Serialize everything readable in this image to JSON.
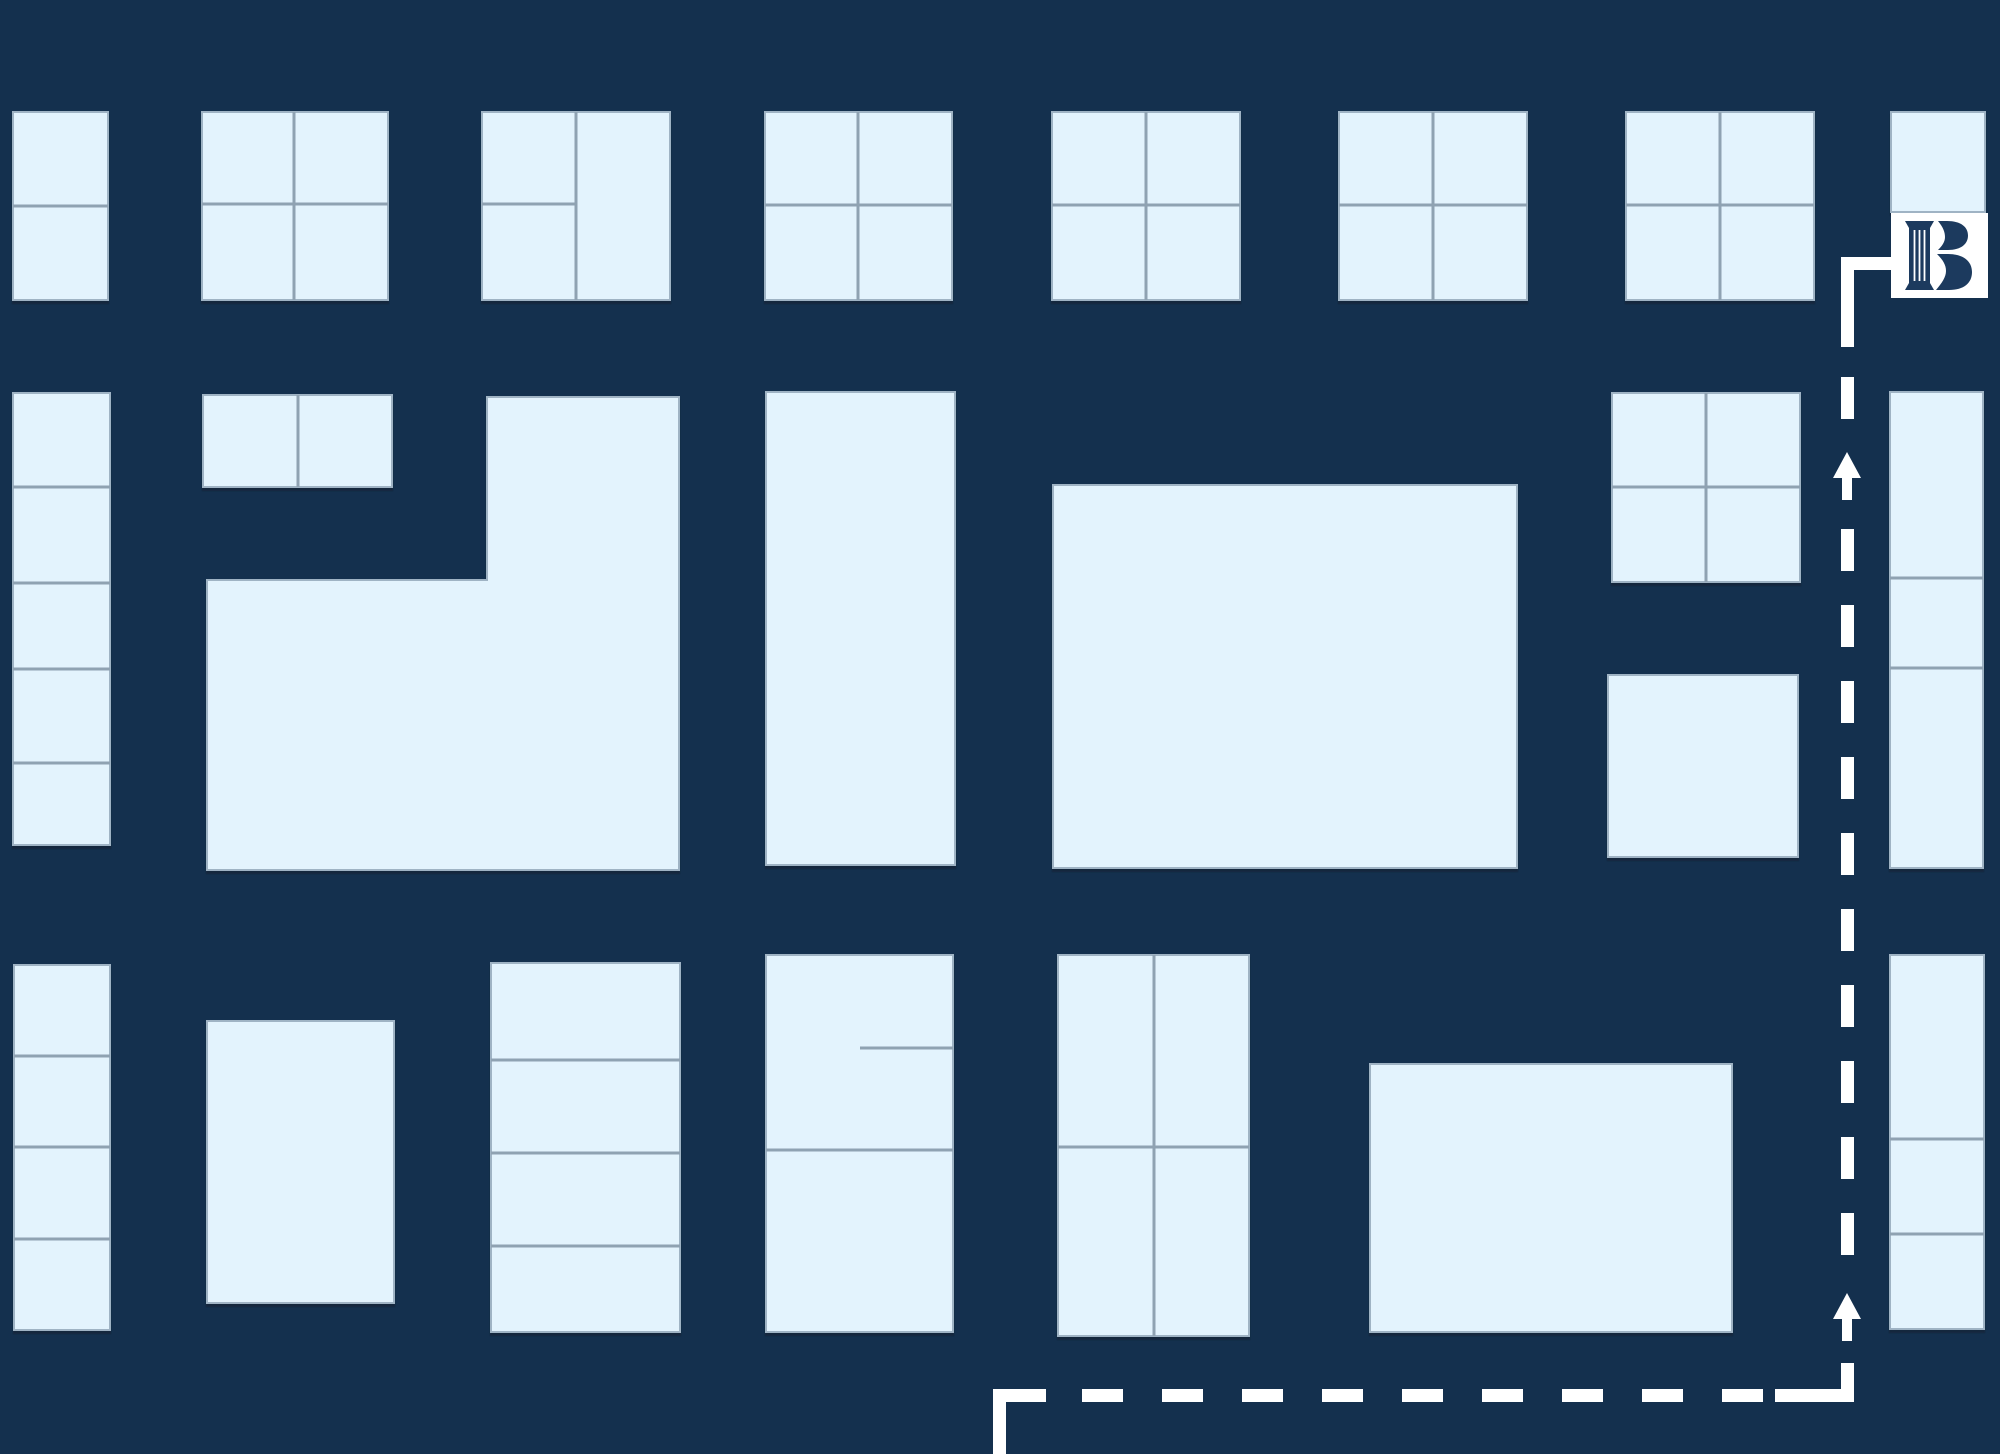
{
  "canvas": {
    "width": 2000,
    "height": 1454
  },
  "palette": {
    "background": "#14304E",
    "block_fill": "#E3F3FD",
    "block_stroke": "#9FB3C4",
    "block_shadow": "#0A1C30",
    "divider": "#8FA2B2",
    "route": "#FFFFFF",
    "marker_box": "#FFFFFF",
    "marker_glyph": "#1C3A5E"
  },
  "marker": {
    "label": "B",
    "icon": "bank-column-b-logo",
    "x": 1891,
    "y": 213,
    "width": 97,
    "height": 85
  },
  "blocks": [
    {
      "x": 13,
      "y": 112,
      "w": 95,
      "h": 188,
      "dividers": [
        {
          "o": "h",
          "pos": 206,
          "from": 13,
          "to": 108
        }
      ]
    },
    {
      "x": 202,
      "y": 112,
      "w": 186,
      "h": 188,
      "dividers": [
        {
          "o": "v",
          "pos": 294,
          "from": 112,
          "to": 300
        },
        {
          "o": "h",
          "pos": 204,
          "from": 202,
          "to": 388
        }
      ]
    },
    {
      "x": 482,
      "y": 112,
      "w": 188,
      "h": 188,
      "dividers": [
        {
          "o": "v",
          "pos": 576,
          "from": 112,
          "to": 300
        },
        {
          "o": "h",
          "pos": 204,
          "from": 482,
          "to": 576
        }
      ]
    },
    {
      "x": 765,
      "y": 112,
      "w": 187,
      "h": 188,
      "dividers": [
        {
          "o": "v",
          "pos": 858,
          "from": 112,
          "to": 300
        },
        {
          "o": "h",
          "pos": 205,
          "from": 765,
          "to": 952
        }
      ]
    },
    {
      "x": 1052,
      "y": 112,
      "w": 188,
      "h": 188,
      "dividers": [
        {
          "o": "v",
          "pos": 1146,
          "from": 112,
          "to": 300
        },
        {
          "o": "h",
          "pos": 205,
          "from": 1052,
          "to": 1240
        }
      ]
    },
    {
      "x": 1339,
      "y": 112,
      "w": 188,
      "h": 188,
      "dividers": [
        {
          "o": "v",
          "pos": 1433,
          "from": 112,
          "to": 300
        },
        {
          "o": "h",
          "pos": 205,
          "from": 1339,
          "to": 1527
        }
      ]
    },
    {
      "x": 1626,
      "y": 112,
      "w": 188,
      "h": 188,
      "dividers": [
        {
          "o": "v",
          "pos": 1720,
          "from": 112,
          "to": 300
        },
        {
          "o": "h",
          "pos": 205,
          "from": 1626,
          "to": 1814
        }
      ]
    },
    {
      "x": 1891,
      "y": 112,
      "w": 94,
      "h": 100,
      "dividers": []
    },
    {
      "x": 13,
      "y": 393,
      "w": 97,
      "h": 452,
      "dividers": [
        {
          "o": "h",
          "pos": 487,
          "from": 13,
          "to": 110
        },
        {
          "o": "h",
          "pos": 583,
          "from": 13,
          "to": 110
        },
        {
          "o": "h",
          "pos": 669,
          "from": 13,
          "to": 110
        },
        {
          "o": "h",
          "pos": 763,
          "from": 13,
          "to": 110
        }
      ]
    },
    {
      "x": 203,
      "y": 395,
      "w": 189,
      "h": 92,
      "dividers": [
        {
          "o": "v",
          "pos": 298,
          "from": 395,
          "to": 487
        }
      ]
    },
    {
      "type": "polygon",
      "points": "487,397 679,397 679,870 207,870 207,580 487,580",
      "dividers": []
    },
    {
      "x": 766,
      "y": 392,
      "w": 189,
      "h": 473,
      "dividers": []
    },
    {
      "x": 1053,
      "y": 485,
      "w": 464,
      "h": 383,
      "dividers": []
    },
    {
      "x": 1612,
      "y": 393,
      "w": 188,
      "h": 189,
      "dividers": [
        {
          "o": "v",
          "pos": 1706,
          "from": 393,
          "to": 582
        },
        {
          "o": "h",
          "pos": 487,
          "from": 1612,
          "to": 1800
        }
      ]
    },
    {
      "x": 1608,
      "y": 675,
      "w": 190,
      "h": 182,
      "dividers": []
    },
    {
      "x": 1890,
      "y": 392,
      "w": 93,
      "h": 476,
      "dividers": [
        {
          "o": "h",
          "pos": 578,
          "from": 1890,
          "to": 1983
        },
        {
          "o": "h",
          "pos": 668,
          "from": 1890,
          "to": 1983
        }
      ]
    },
    {
      "x": 14,
      "y": 965,
      "w": 96,
      "h": 365,
      "dividers": [
        {
          "o": "h",
          "pos": 1056,
          "from": 14,
          "to": 110
        },
        {
          "o": "h",
          "pos": 1147,
          "from": 14,
          "to": 110
        },
        {
          "o": "h",
          "pos": 1239,
          "from": 14,
          "to": 110
        }
      ]
    },
    {
      "x": 207,
      "y": 1021,
      "w": 187,
      "h": 282,
      "dividers": []
    },
    {
      "x": 491,
      "y": 963,
      "w": 189,
      "h": 369,
      "dividers": [
        {
          "o": "h",
          "pos": 1060,
          "from": 491,
          "to": 680
        },
        {
          "o": "h",
          "pos": 1153,
          "from": 491,
          "to": 680
        },
        {
          "o": "h",
          "pos": 1246,
          "from": 491,
          "to": 680
        }
      ]
    },
    {
      "x": 766,
      "y": 955,
      "w": 187,
      "h": 377,
      "dividers": [
        {
          "o": "h",
          "pos": 1048,
          "from": 860,
          "to": 953
        },
        {
          "o": "h",
          "pos": 1150,
          "from": 766,
          "to": 953
        }
      ]
    },
    {
      "x": 1058,
      "y": 955,
      "w": 191,
      "h": 381,
      "dividers": [
        {
          "o": "v",
          "pos": 1154,
          "from": 955,
          "to": 1336
        },
        {
          "o": "h",
          "pos": 1147,
          "from": 1058,
          "to": 1249
        }
      ]
    },
    {
      "x": 1370,
      "y": 1064,
      "w": 362,
      "h": 268,
      "dividers": []
    },
    {
      "x": 1890,
      "y": 955,
      "w": 94,
      "h": 374,
      "dividers": [
        {
          "o": "h",
          "pos": 1139,
          "from": 1890,
          "to": 1984
        },
        {
          "o": "h",
          "pos": 1234,
          "from": 1890,
          "to": 1984
        }
      ]
    }
  ],
  "route": {
    "thickness": 13,
    "solid_segments": [
      {
        "x": 1841,
        "y": 257,
        "w": 50,
        "h": 13
      },
      {
        "x": 1841,
        "y": 257,
        "w": 13,
        "h": 90
      },
      {
        "x": 1841,
        "y": 1363,
        "w": 13,
        "h": 39
      },
      {
        "x": 1775,
        "y": 1389,
        "w": 79,
        "h": 13
      },
      {
        "x": 993,
        "y": 1389,
        "w": 53,
        "h": 13
      },
      {
        "x": 993,
        "y": 1389,
        "w": 13,
        "h": 65
      }
    ],
    "dashed_segments": [
      {
        "x1": 1847.5,
        "y1": 377,
        "x2": 1847.5,
        "y2": 419,
        "dash": "42 34"
      },
      {
        "x1": 1847.5,
        "y1": 529,
        "x2": 1847.5,
        "y2": 1255,
        "dash": "42 34"
      },
      {
        "x1": 1082,
        "y1": 1395.5,
        "x2": 1763,
        "y2": 1395.5,
        "dash": "41 39"
      }
    ],
    "arrows_up": [
      {
        "cx": 1847,
        "tip_y": 452
      },
      {
        "cx": 1847,
        "tip_y": 1293
      }
    ]
  }
}
